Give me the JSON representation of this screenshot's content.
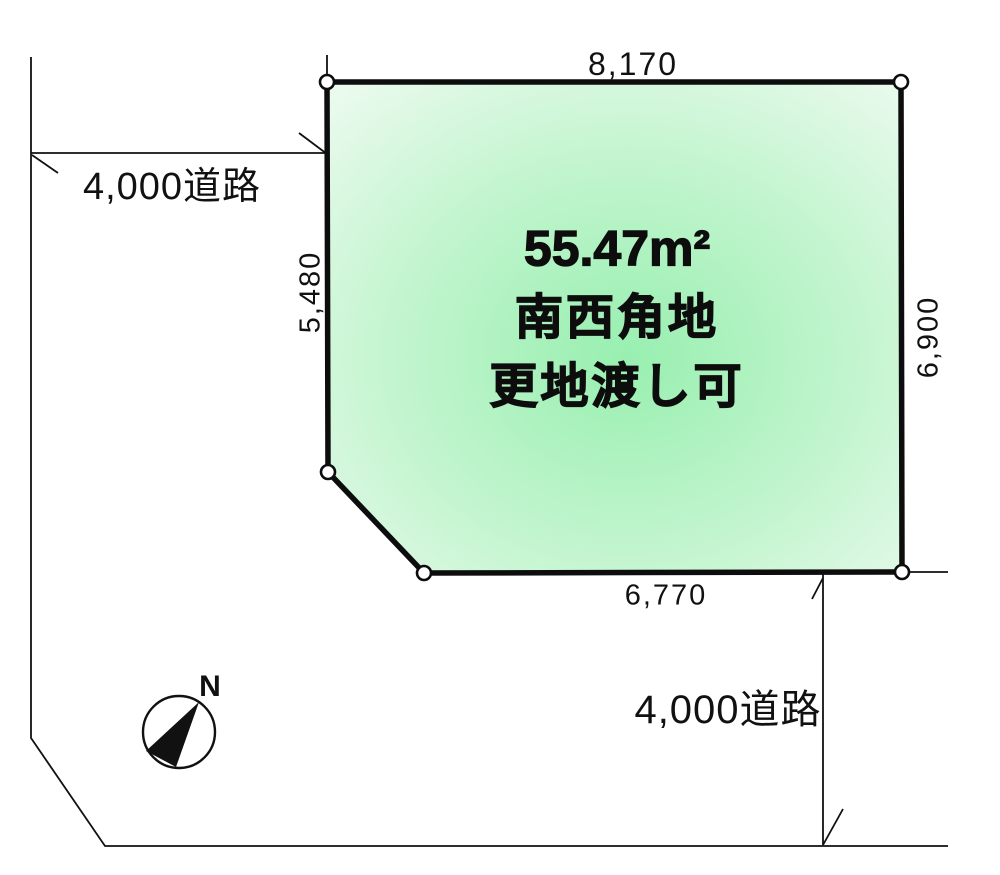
{
  "plot": {
    "area_label": "55.47m²",
    "location_label": "南西角地",
    "condition_label": "更地渡し可"
  },
  "dimensions": {
    "top": "8,170",
    "left": "5,480",
    "right": "6,900",
    "bottom": "6,770"
  },
  "roads": {
    "left": "4,000道路",
    "bottom": "4,000道路"
  },
  "compass": {
    "north_label": "N"
  },
  "colors": {
    "plot_center_green": "#98efb0",
    "plot_mid_green": "#c3f5cf",
    "plot_edge_green": "#ebfaee",
    "line_black": "#111111",
    "background": "#ffffff"
  }
}
